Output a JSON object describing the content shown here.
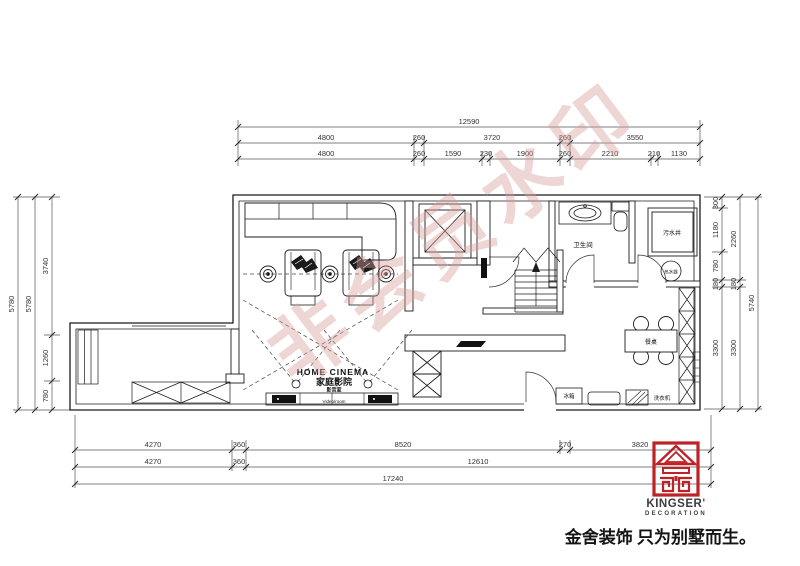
{
  "watermark": {
    "text": "非会员水印"
  },
  "rooms": {
    "cinema_en": "HOME CINEMA",
    "cinema_cn": "家庭影院",
    "cinema_sub": "影音室",
    "cinema_note": "Video/room",
    "bathroom": "卫生间",
    "sewage": "污水井",
    "heater": "热水器",
    "table": "餐桌",
    "fridge": "冰箱",
    "washer": "洗衣机"
  },
  "dimensions": {
    "top": {
      "total": "12590",
      "row2": [
        "4800",
        "260",
        "3720",
        "260",
        "3550"
      ],
      "row3": [
        "4800",
        "260",
        "1590",
        "230",
        "1900",
        "260",
        "2210",
        "210",
        "1130"
      ]
    },
    "left": {
      "outer": "5780",
      "middle": "5780",
      "inner": [
        "3740",
        "1260",
        "780"
      ]
    },
    "right": {
      "inner": [
        "300",
        "1180",
        "780",
        "180",
        "3300"
      ],
      "middle": [
        "2260",
        "180",
        "3300"
      ],
      "outer": "5740"
    },
    "bottom": {
      "row1": [
        "4270",
        "360",
        "8520",
        "270",
        "3820"
      ],
      "row2": [
        "4270",
        "360",
        "12610"
      ],
      "total": "17240"
    }
  },
  "logo": {
    "brand": "KINGSER",
    "apostrophe": "'",
    "division": "DECORATION",
    "slogan": "金舍装饰 只为别墅而生。",
    "seal_color": "#bf2126"
  }
}
